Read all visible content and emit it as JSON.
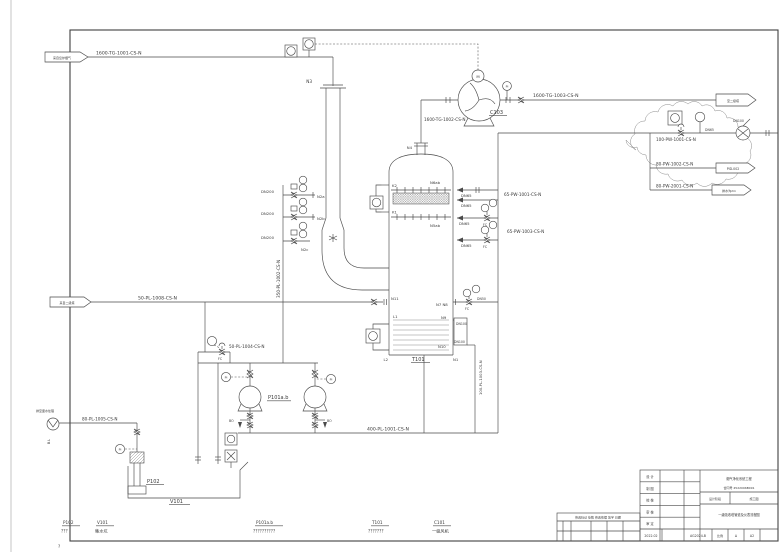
{
  "drawing": {
    "connectors": {
      "flue_gas_in": "来自窑炉烟气",
      "from_stage2": "来自二级塔",
      "to_stage2": "至二级塔",
      "pid_002": "PID-002",
      "drain_ditch": "排水沟2m",
      "bl": "B.L",
      "to_waste": "排至废水处理"
    },
    "pipes": {
      "tg1001": "1600-TG-1001-CS-N",
      "tg1002": "1600-TG-1002-CS-N",
      "tg1003": "1600-TG-1003-CS-N",
      "pw100_1001": "100-PW-1001-CS-N",
      "pw80_1002": "80-PW-1002-CS-N",
      "pw80_2001": "80-PW-2001-CS-N",
      "pw65_1001": "65-PW-1001-CS-N",
      "pw65_1003": "65-PW-1003-CS-N",
      "pl50_1008": "50-PL-1008-CS-N",
      "pl350_1002": "350-PL-1002-CS-N",
      "pl50_1004": "50-PL-1004-CS-N",
      "pl400_1001": "400-PL-1001-CS-N",
      "pl80_1005": "80-PL-1005-CS-N",
      "pl100_1003": "100-PL-1003-CS-N"
    },
    "sizes": {
      "dn200": "DN200",
      "dn65": "DN65",
      "dn50": "DN50",
      "dn100": "DN100"
    },
    "valve_codes": {
      "fc": "FC",
      "bo": "BO"
    },
    "nozzles": {
      "n1": "N1",
      "n2a": "N2a",
      "n2b": "N2b",
      "n2c": "N2c",
      "n3": "N3",
      "n4": "N4",
      "n5ab": "N5ab",
      "n6ab": "N6ab",
      "n7n8": "N7 N8",
      "n9": "N9",
      "n10": "N10",
      "n11": "N11",
      "k1": "K1",
      "k2": "K2",
      "l1": "L1",
      "l2": "L2"
    },
    "instruments": {
      "m": "M",
      "pi": "PI"
    },
    "equipment_tags": {
      "t101": "T101",
      "c103": "C103",
      "p101ab": "P101a.b",
      "p102": "P102",
      "v101": "V101"
    },
    "legend": {
      "items": [
        {
          "tag": "P102",
          "desc": "???"
        },
        {
          "tag": "V101",
          "desc": "集水坑"
        },
        {
          "tag": "P101a.b",
          "desc": "??????????"
        },
        {
          "tag": "T101",
          "desc": "???????"
        },
        {
          "tag": "C101",
          "desc": "一级风机"
        }
      ],
      "note": "?"
    },
    "title_block": {
      "rev_header": "修改标记 处数 修改依据 签字 日期",
      "sign_rows": [
        {
          "label": "设 计"
        },
        {
          "label": "制 图"
        },
        {
          "label": "校 核"
        },
        {
          "label": "审 核"
        },
        {
          "label": "审 定"
        }
      ],
      "project_name": "烟气净化系统工程",
      "contract_line": "合同号 4522096B091",
      "stage_label": "设计阶段",
      "stage_value": "施工图",
      "drawing_title": "一级吸收塔管道及仪表流程图",
      "date": "2022.02",
      "drawing_no": "AG2024-B",
      "scale_label": "比例",
      "rev_mark": "Δ",
      "sheet": "A2"
    }
  }
}
